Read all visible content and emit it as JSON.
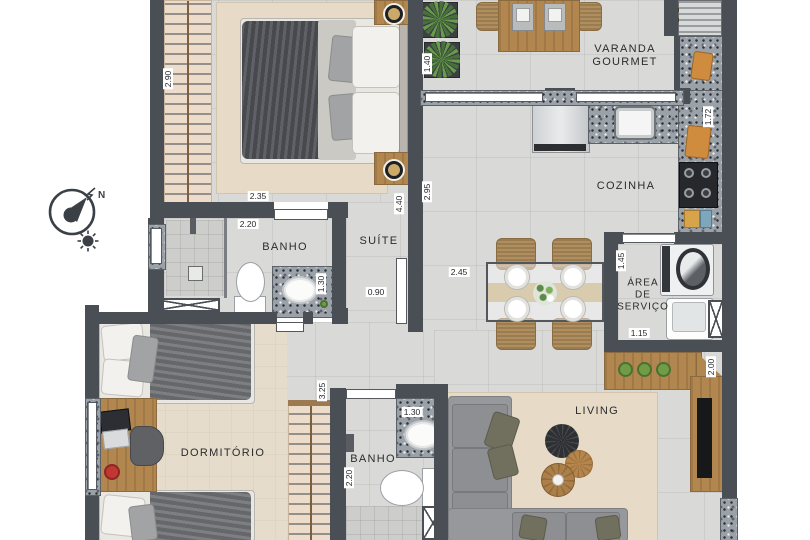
{
  "compass": {
    "north": "N"
  },
  "rooms": {
    "varanda": {
      "line1": "VARANDA",
      "line2": "GOURMET"
    },
    "cozinha": {
      "label": "COZINHA"
    },
    "servico": {
      "line1": "ÁREA",
      "line2": "DE",
      "line3": "SERVIÇO"
    },
    "suite": {
      "label": "SUÍTE"
    },
    "banho_suite": {
      "label": "BANHO"
    },
    "banho_social": {
      "label": "BANHO"
    },
    "dormitorio": {
      "label": "DORMITÓRIO"
    },
    "living": {
      "label": "LIVING"
    }
  },
  "dimensions": {
    "suite_closet": "2.90",
    "suite_bed": "2.35",
    "banho_suite_width": "2.20",
    "banho_suite_counter": "1.30",
    "suite_door": "0.90",
    "suite_depth": "4.40",
    "varanda_depth": "1.40",
    "cozinha_wall": "2.95",
    "dining_width": "2.45",
    "cozinha_counter": "1.72",
    "servico_depth": "1.45",
    "servico_width": "1.15",
    "tv_panel": "2.00",
    "hall_closet": "3.25",
    "banho_social_counter": "1.30",
    "banho_social_width": "2.20"
  },
  "colors": {
    "wall": "#4a4f55",
    "floor_tile": "#d9d9d7",
    "carpet": "#e6dccb",
    "granite": "#9aa1a8",
    "wood": "#b2874f",
    "sofa": "#96989b",
    "plant": "#6a9a4c",
    "accent_board": "#cf8c3e"
  },
  "icons": {
    "compass": "compass-north-arrow",
    "sun": "sun-icon"
  }
}
